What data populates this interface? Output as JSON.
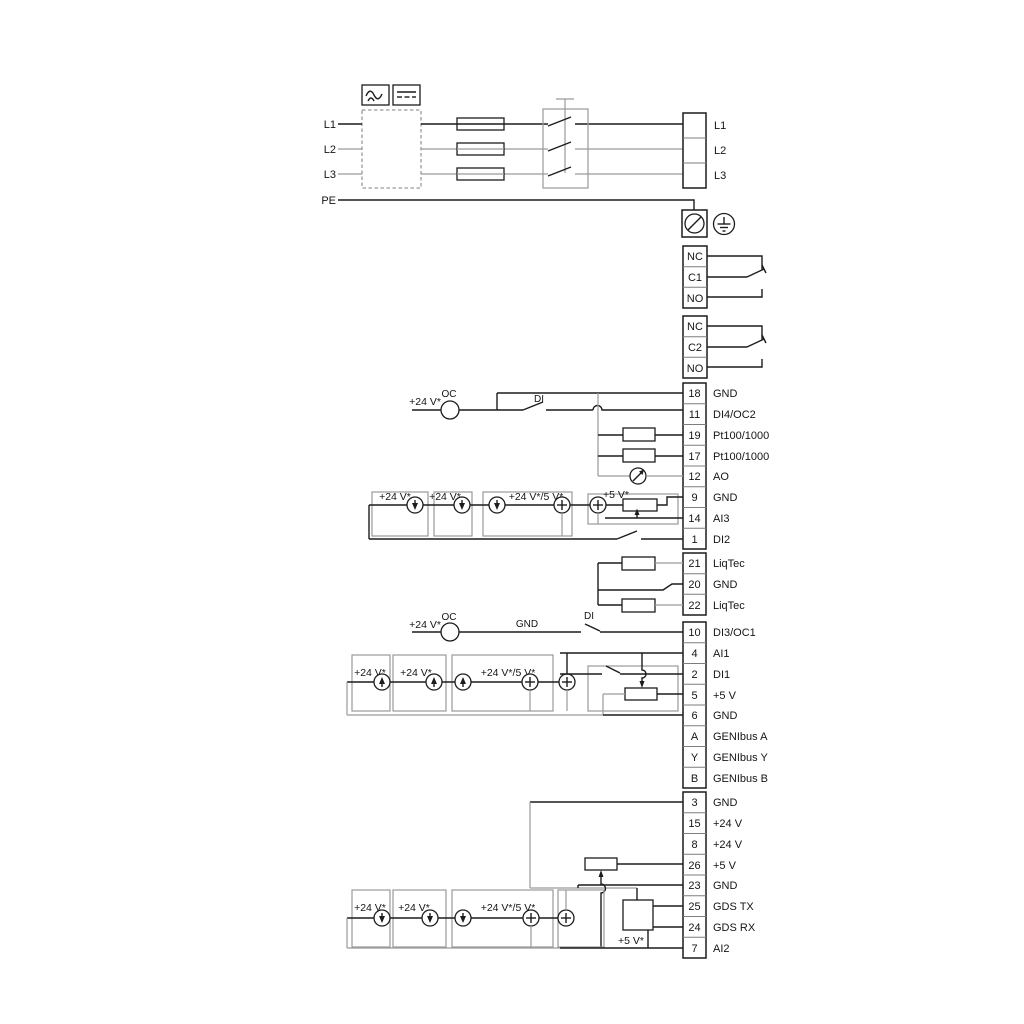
{
  "colors": {
    "wire": "#1c1c1c",
    "secondary_wire": "#9a9a9a",
    "background": "#ffffff"
  },
  "power": {
    "in": [
      "L1",
      "L2",
      "L3",
      "PE"
    ],
    "out": [
      "L1",
      "L2",
      "L3"
    ]
  },
  "relay1": [
    "NC",
    "C1",
    "NO"
  ],
  "relay2": [
    "NC",
    "C2",
    "NO"
  ],
  "t1": {
    "rows": [
      {
        "n": "18",
        "l": "GND"
      },
      {
        "n": "11",
        "l": "DI4/OC2"
      },
      {
        "n": "19",
        "l": "Pt100/1000"
      },
      {
        "n": "17",
        "l": "Pt100/1000"
      },
      {
        "n": "12",
        "l": "AO"
      },
      {
        "n": "9",
        "l": "GND"
      },
      {
        "n": "14",
        "l": "AI3"
      },
      {
        "n": "1",
        "l": "DI2"
      }
    ]
  },
  "t2": {
    "rows": [
      {
        "n": "21",
        "l": "LiqTec"
      },
      {
        "n": "20",
        "l": "GND"
      },
      {
        "n": "22",
        "l": "LiqTec"
      }
    ]
  },
  "t3": {
    "rows": [
      {
        "n": "10",
        "l": "DI3/OC1"
      },
      {
        "n": "4",
        "l": "AI1"
      },
      {
        "n": "2",
        "l": "DI1"
      },
      {
        "n": "5",
        "l": "+5 V"
      },
      {
        "n": "6",
        "l": "GND"
      },
      {
        "n": "A",
        "l": "GENIbus A"
      },
      {
        "n": "Y",
        "l": "GENIbus Y"
      },
      {
        "n": "B",
        "l": "GENIbus B"
      }
    ]
  },
  "t4": {
    "rows": [
      {
        "n": "3",
        "l": "GND"
      },
      {
        "n": "15",
        "l": "+24 V"
      },
      {
        "n": "8",
        "l": "+24 V"
      },
      {
        "n": "26",
        "l": "+5 V"
      },
      {
        "n": "23",
        "l": "GND"
      },
      {
        "n": "25",
        "l": "GDS TX"
      },
      {
        "n": "24",
        "l": "GDS RX"
      },
      {
        "n": "7",
        "l": "AI2"
      }
    ]
  },
  "ann": {
    "v24": "+24 V*",
    "v24_5": "+24 V*/5 V*",
    "v5": "+5 V*",
    "oc": "OC",
    "di": "DI",
    "gnd": "GND"
  },
  "icons": {
    "ac_box": "ac-waveform-icon",
    "dc_box": "dc-line-icon",
    "pe_terminal": "pe-terminal-icon",
    "earth": "earth-ground-icon",
    "meter": "analog-output-meter-icon",
    "current_source": "current-source-icon"
  }
}
